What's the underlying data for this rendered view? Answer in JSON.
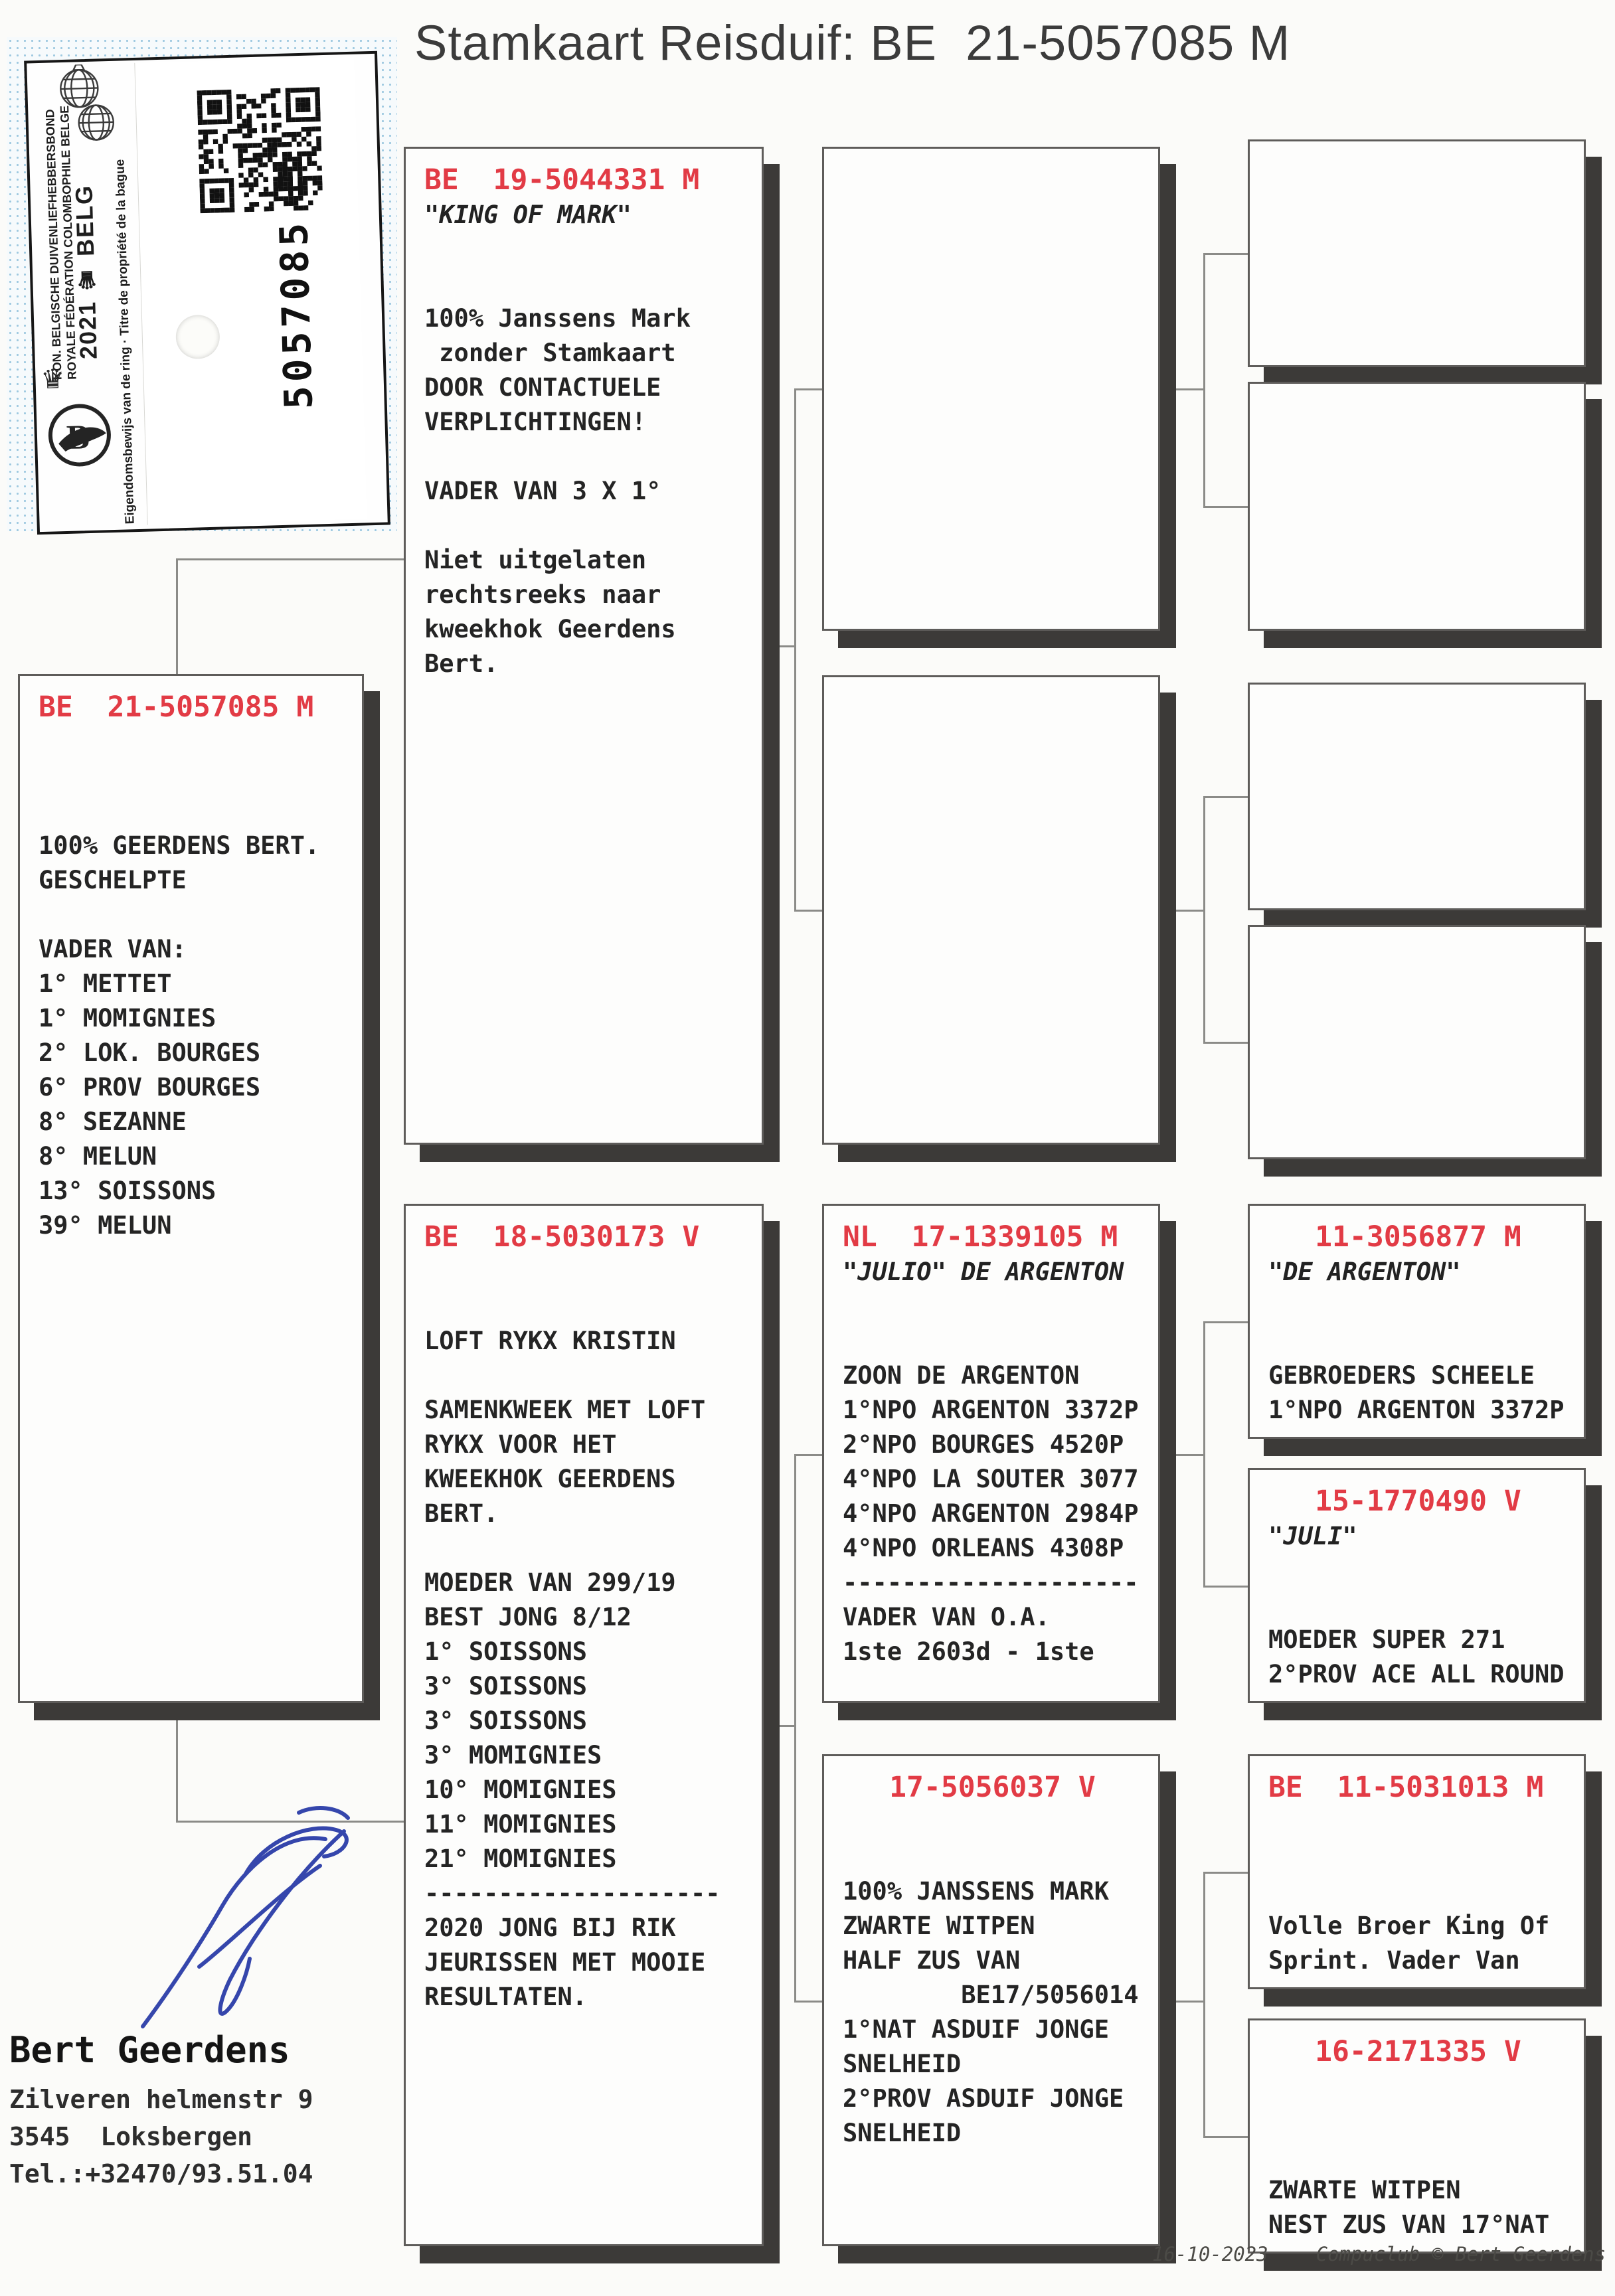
{
  "page": {
    "title": "Stamkaart Reisduif: BE  21-5057085 M"
  },
  "stamp": {
    "federation_line1": "KON. BELGISCHE DUIVENLIEFHEBBERSBOND",
    "federation_line2": "ROYALE FÉDÉRATION COLOMBOPHILE BELGE",
    "year_country": "2021 ♛ BELG",
    "ownership_text": "Eigendomsbewijs van de ring · Titre de propriété de la bague",
    "ring_number": "5057085"
  },
  "pedigree": {
    "subject": {
      "ring": "BE  21-5057085 M",
      "lines": [
        "",
        "",
        "",
        "100% GEERDENS BERT.",
        "GESCHELPTE",
        "",
        "VADER VAN:",
        "1° METTET",
        "1° MOMIGNIES",
        "2° LOK. BOURGES",
        "6° PROV BOURGES",
        "8° SEZANNE",
        "8° MELUN",
        "13° SOISSONS",
        "39° MELUN"
      ]
    },
    "father": {
      "ring": "BE  19-5044331 M",
      "name": "\"KING OF MARK\"",
      "lines": [
        "",
        "",
        "100% Janssens Mark",
        " zonder Stamkaart",
        "DOOR CONTACTUELE",
        "VERPLICHTINGEN!",
        "",
        "VADER VAN 3 X 1°",
        "",
        "Niet uitgelaten",
        "rechtsreeks naar",
        "kweekhok Geerdens",
        "Bert."
      ]
    },
    "mother": {
      "ring": "BE  18-5030173 V",
      "lines": [
        "",
        "",
        "LOFT RYKX KRISTIN",
        "",
        "SAMENKWEEK MET LOFT",
        "RYKX VOOR HET",
        "KWEEKHOK GEERDENS",
        "BERT.",
        "",
        "MOEDER VAN 299/19",
        "BEST JONG 8/12",
        "1° SOISSONS",
        "3° SOISSONS",
        "3° SOISSONS",
        "3° MOMIGNIES",
        "10° MOMIGNIES",
        "11° MOMIGNIES",
        "21° MOMIGNIES",
        "--------------------",
        "2020 JONG BIJ RIK",
        "JEURISSEN MET MOOIE",
        "RESULTATEN."
      ]
    },
    "ff": {
      "ring": "",
      "lines": []
    },
    "fm": {
      "ring": "",
      "lines": []
    },
    "mf": {
      "ring": "NL  17-1339105 M",
      "name": "\"JULIO\" DE ARGENTON",
      "lines": [
        "",
        "",
        "ZOON DE ARGENTON",
        "1°NPO ARGENTON 3372P",
        "2°NPO BOURGES 4520P",
        "4°NPO LA SOUTER 3077",
        "4°NPO ARGENTON 2984P",
        "4°NPO ORLEANS 4308P",
        "--------------------",
        "VADER VAN O.A.",
        "1ste 2603d - 1ste"
      ]
    },
    "mm": {
      "ring": "17-5056037 V",
      "lines": [
        "",
        "",
        "100% JANSSENS MARK",
        "ZWARTE WITPEN",
        "HALF ZUS VAN",
        "        BE17/5056014",
        "1°NAT ASDUIF JONGE",
        "SNELHEID",
        "2°PROV ASDUIF JONGE",
        "SNELHEID"
      ]
    },
    "fff": {
      "ring": "",
      "lines": []
    },
    "ffm": {
      "ring": "",
      "lines": []
    },
    "fmf": {
      "ring": "",
      "lines": []
    },
    "fmm": {
      "ring": "",
      "lines": []
    },
    "mff": {
      "ring": "11-3056877 M",
      "name": "\"DE ARGENTON\"",
      "lines": [
        "",
        "",
        "GEBROEDERS SCHEELE",
        "1°NPO ARGENTON 3372P"
      ]
    },
    "mfm": {
      "ring": "15-1770490 V",
      "name": "\"JULI\"",
      "lines": [
        "",
        "",
        "MOEDER SUPER 271",
        "2°PROV ACE ALL ROUND"
      ]
    },
    "mmf": {
      "ring": "BE  11-5031013 M",
      "lines": [
        "",
        "",
        "",
        "Volle Broer King Of",
        "Sprint. Vader Van"
      ]
    },
    "mmm": {
      "ring": "16-2171335 V",
      "lines": [
        "",
        "",
        "",
        "ZWARTE WITPEN",
        "NEST ZUS VAN 17°NAT"
      ]
    }
  },
  "owner": {
    "name": "Bert Geerdens",
    "address1": "Zilveren helmenstr 9",
    "address2": "3545  Loksbergen",
    "phone": "Tel.:+32470/93.51.04"
  },
  "footer": {
    "date": "16-10-2023",
    "credit": "Compuclub © Bert Geerdens"
  }
}
